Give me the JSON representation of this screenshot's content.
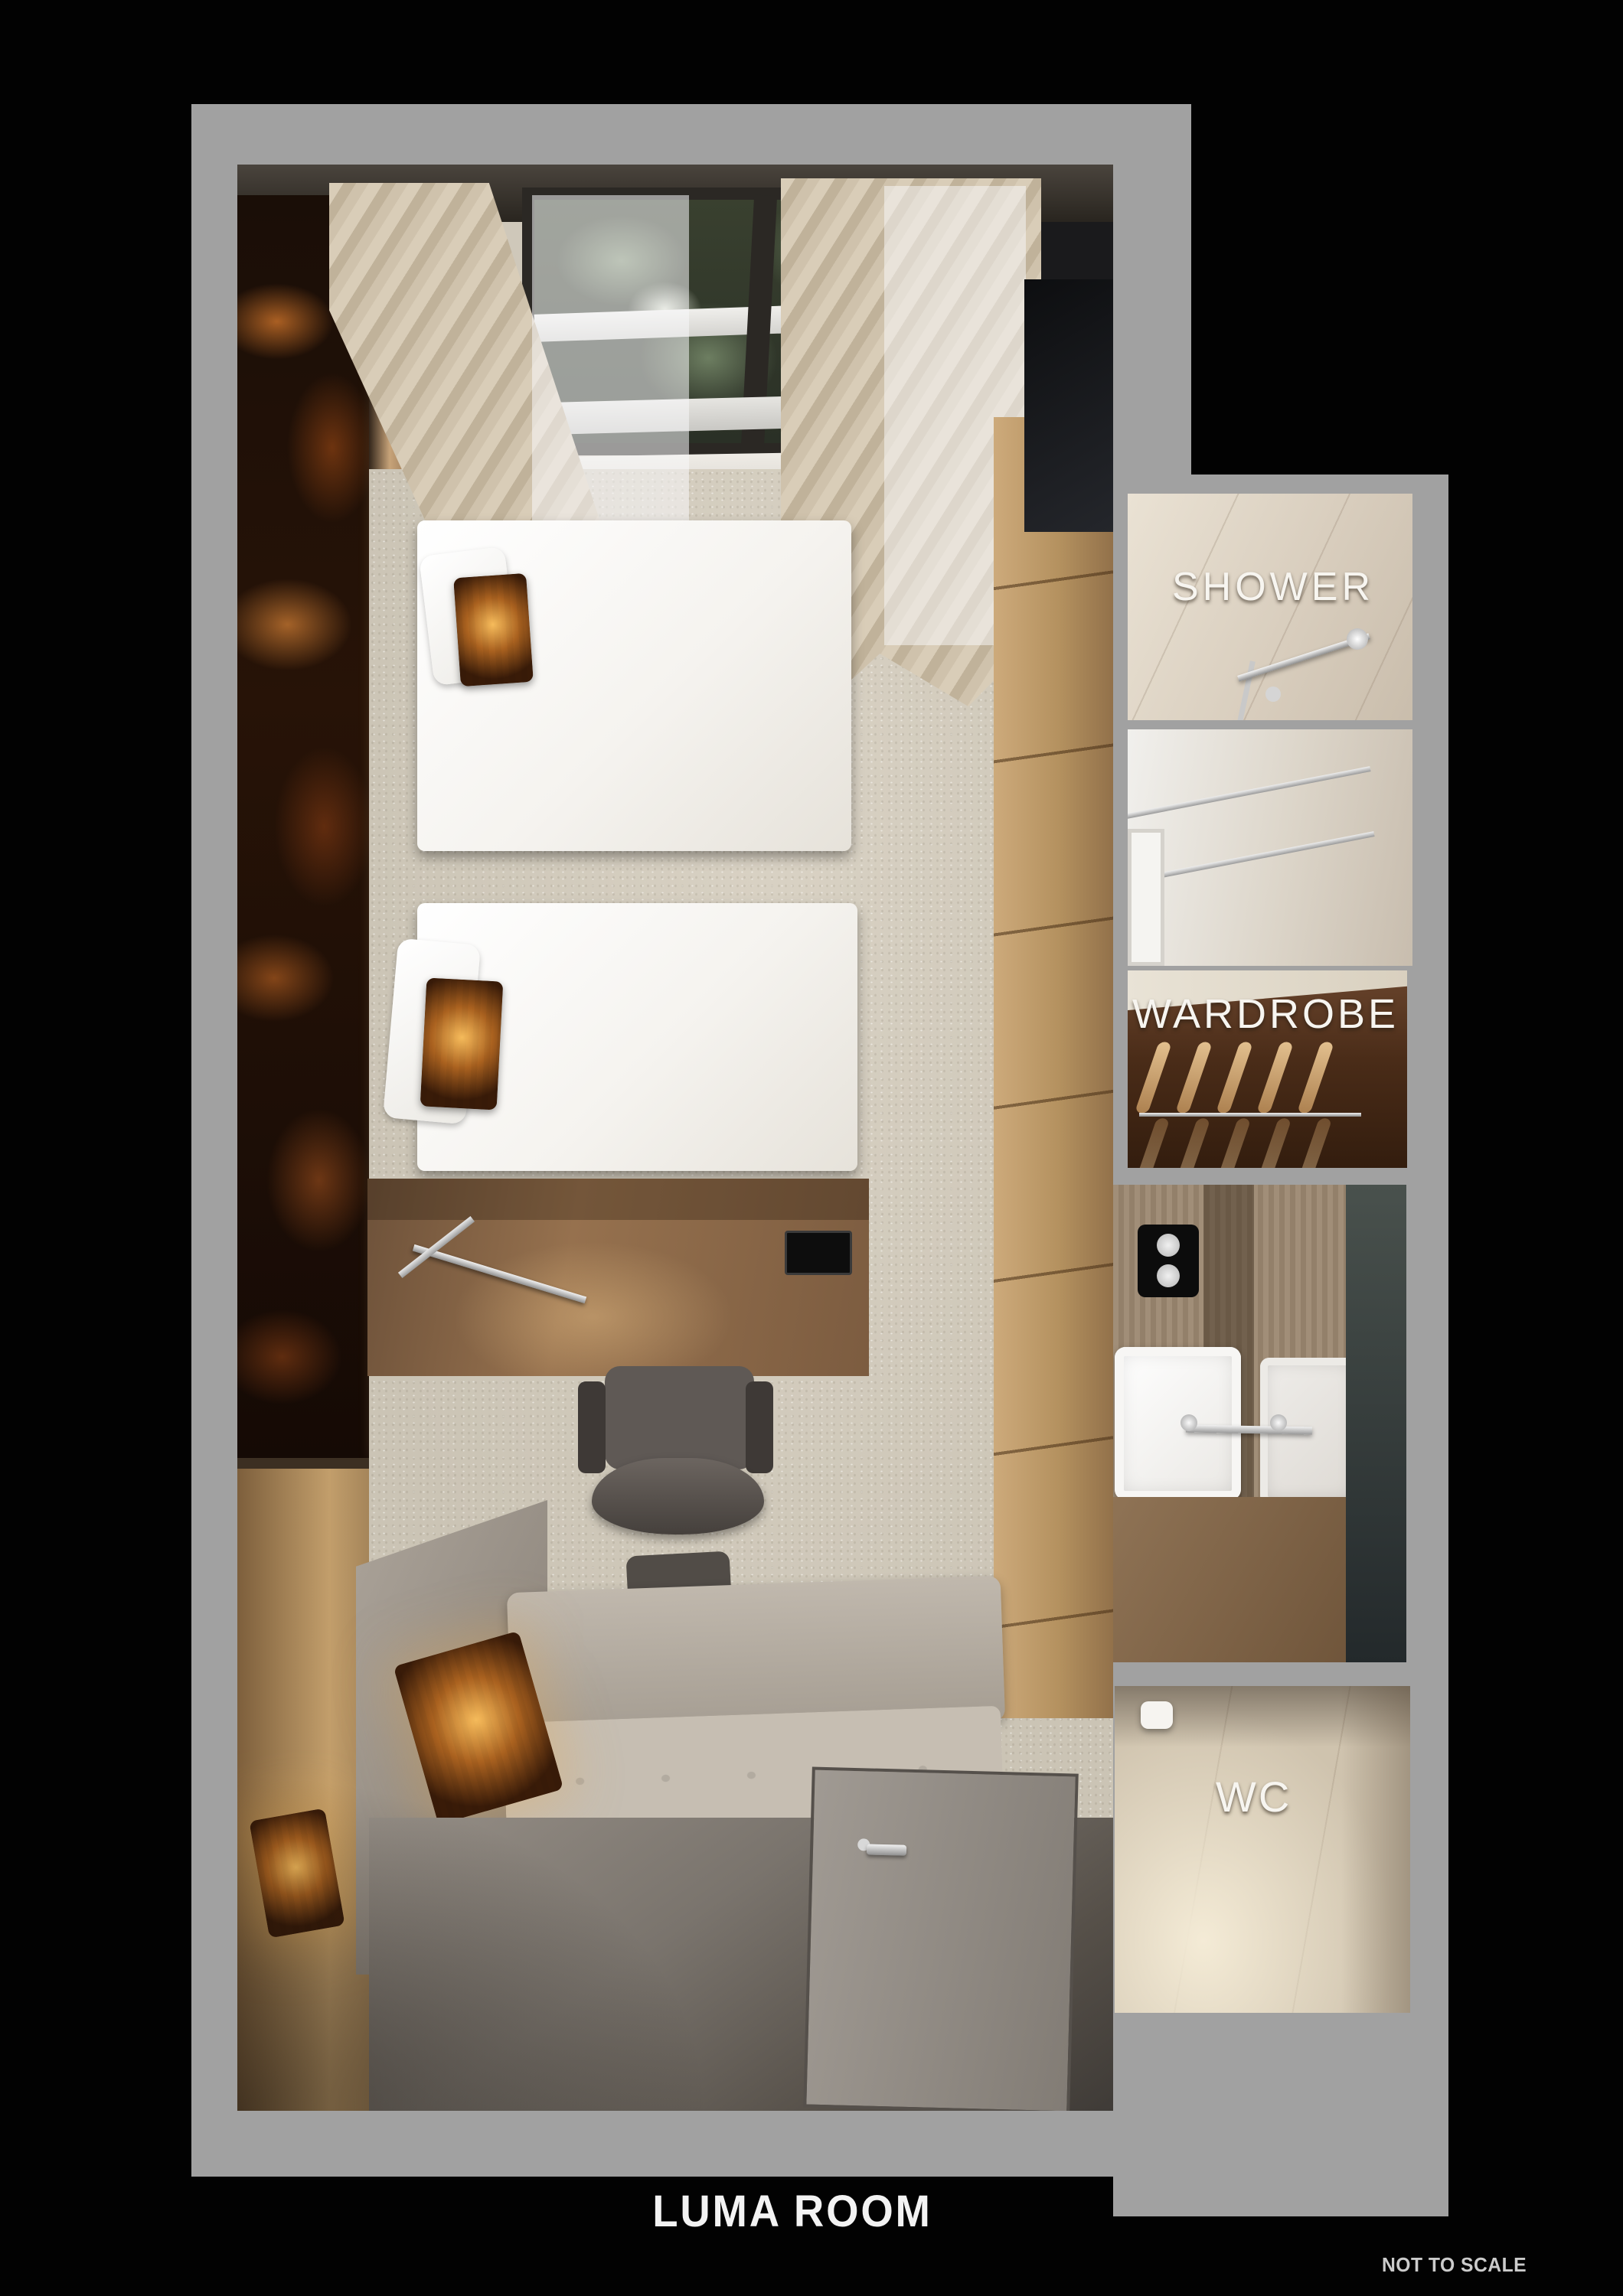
{
  "title": "LUMA ROOM",
  "scale_note": "NOT TO SCALE",
  "areas": {
    "shower": {
      "label": "SHOWER"
    },
    "wardrobe": {
      "label": "WARDROBE"
    },
    "wc": {
      "label": "WC"
    }
  },
  "colors": {
    "background": "#020202",
    "plan_outline": "#a1a1a1",
    "room_label_text": "#f7f5f0",
    "title_text": "#f3f3f3",
    "note_text": "#cbcbcb",
    "carpet": "#cfc8ba",
    "marble_accent": "#a85a1e",
    "wood_accent": "#b4915f"
  }
}
